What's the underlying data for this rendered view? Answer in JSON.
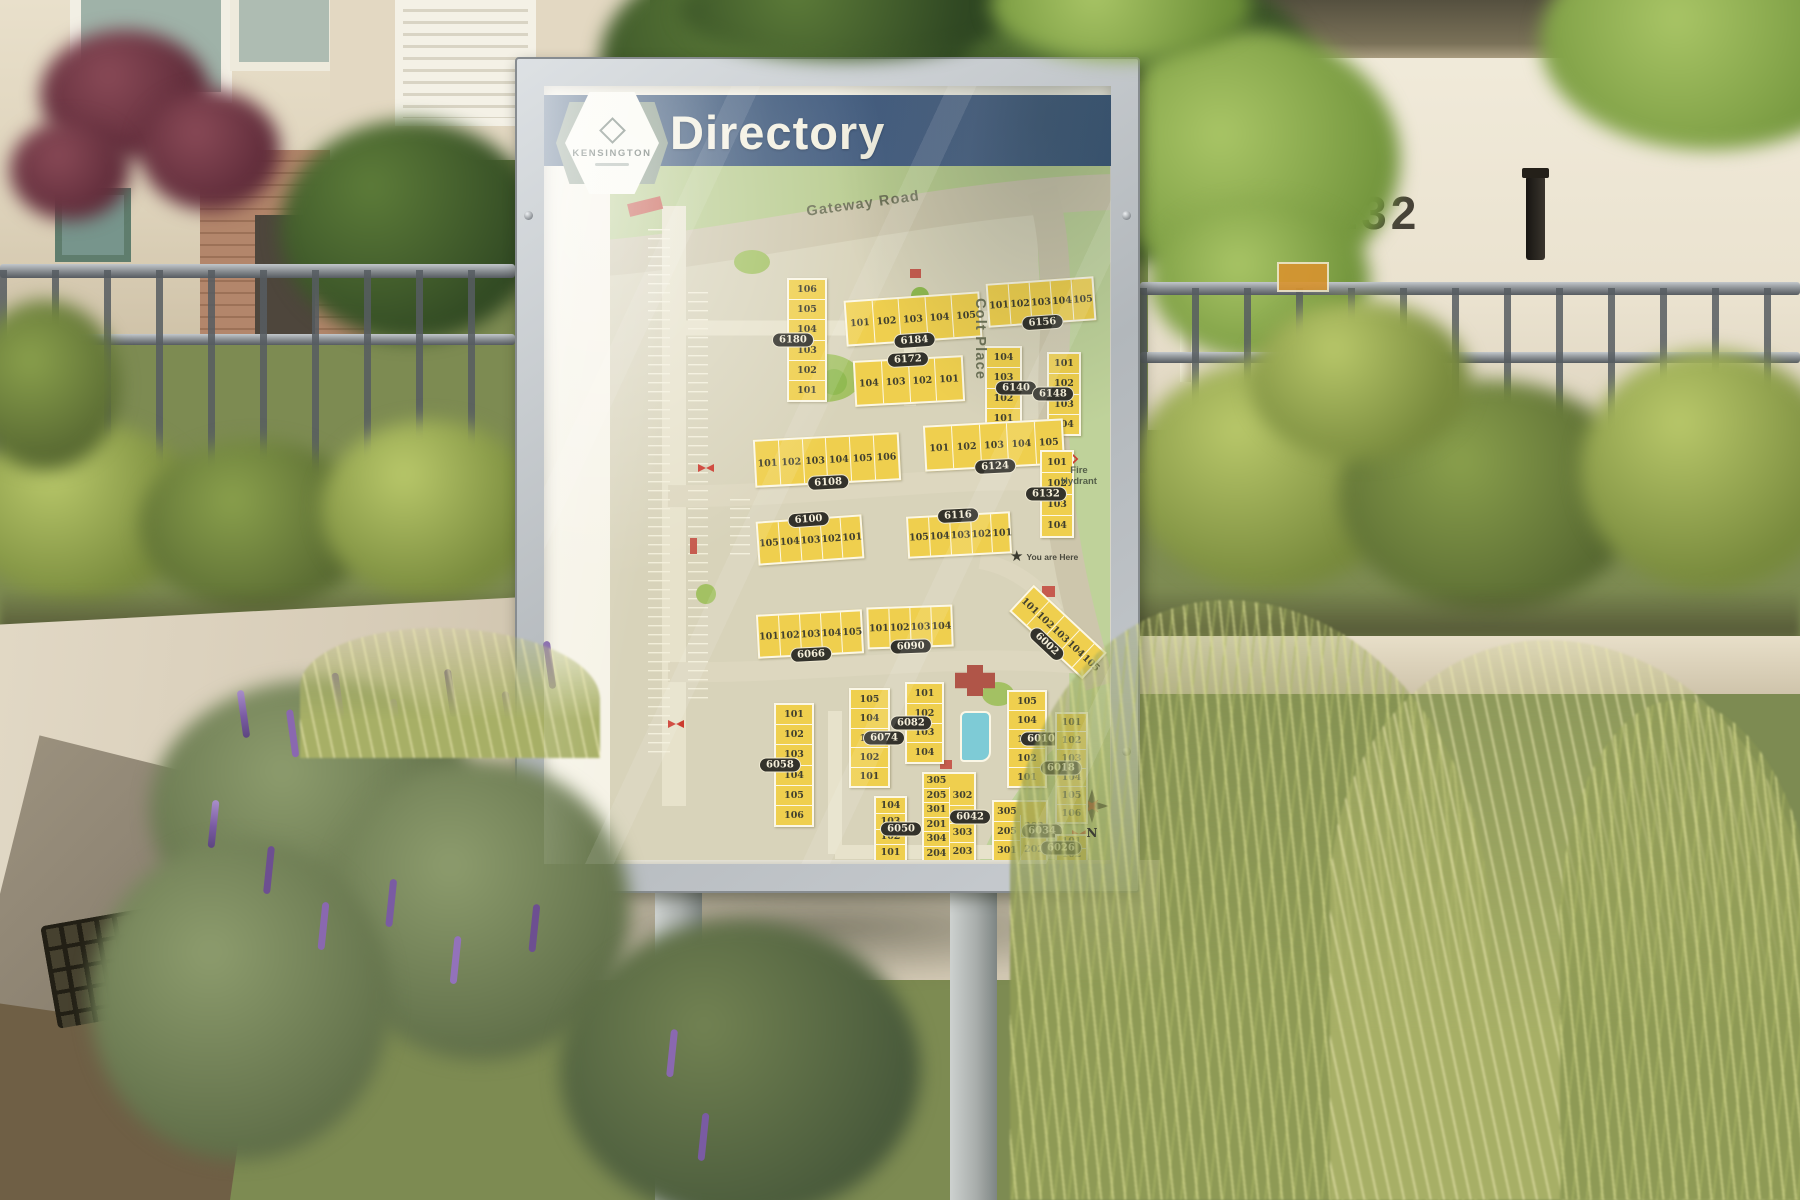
{
  "scene": {
    "right_building_number": "6132"
  },
  "sign": {
    "header": {
      "title": "Directory",
      "brand": "KENSINGTON"
    },
    "map": {
      "streets": [
        {
          "name": "Gateway Road"
        },
        {
          "name": "Colt Place"
        }
      ],
      "you_are_here_label": "You are Here",
      "legend": {
        "fire_hydrant_label": "Fire Hydrant"
      },
      "compass_label": "N",
      "buildings": [
        {
          "id": "6180",
          "ori": "v",
          "x": 177,
          "y": 112,
          "w": 40,
          "h": 124,
          "rot": 0,
          "label": "l",
          "units": [
            "106",
            "105",
            "104",
            "103",
            "102",
            "101"
          ]
        },
        {
          "id": "6184",
          "ori": "h",
          "x": 235,
          "y": 130,
          "w": 136,
          "h": 46,
          "rot": -4,
          "label": "b",
          "units": [
            "101",
            "102",
            "103",
            "104",
            "105"
          ]
        },
        {
          "id": "6156",
          "ori": "h",
          "x": 377,
          "y": 114,
          "w": 108,
          "h": 44,
          "rot": -4,
          "label": "b",
          "units": [
            "101",
            "102",
            "103",
            "104",
            "105"
          ]
        },
        {
          "id": "6172",
          "ori": "h",
          "x": 244,
          "y": 192,
          "w": 110,
          "h": 46,
          "rot": -3,
          "label": "t",
          "units": [
            "104",
            "103",
            "102",
            "101"
          ]
        },
        {
          "id": "6140",
          "ori": "v",
          "x": 375,
          "y": 180,
          "w": 37,
          "h": 84,
          "rot": 0,
          "label": "r",
          "units": [
            "104",
            "103",
            "102",
            "101"
          ]
        },
        {
          "id": "6148",
          "ori": "v",
          "x": 437,
          "y": 186,
          "w": 34,
          "h": 84,
          "rot": 0,
          "label": "l",
          "units": [
            "101",
            "102",
            "103",
            "104"
          ]
        },
        {
          "id": "6108",
          "ori": "h",
          "x": 144,
          "y": 270,
          "w": 146,
          "h": 48,
          "rot": -3,
          "label": "b",
          "units": [
            "101",
            "102",
            "103",
            "104",
            "105",
            "106"
          ]
        },
        {
          "id": "6124",
          "ori": "h",
          "x": 314,
          "y": 256,
          "w": 140,
          "h": 46,
          "rot": -3,
          "label": "b",
          "units": [
            "101",
            "102",
            "103",
            "104",
            "105"
          ]
        },
        {
          "id": "6132",
          "ori": "v",
          "x": 430,
          "y": 284,
          "w": 34,
          "h": 88,
          "rot": 0,
          "label": "l",
          "units": [
            "101",
            "102",
            "103",
            "104"
          ]
        },
        {
          "id": "6100",
          "ori": "h",
          "x": 147,
          "y": 352,
          "w": 106,
          "h": 44,
          "rot": -4,
          "label": "t",
          "units": [
            "105",
            "104",
            "103",
            "102",
            "101"
          ]
        },
        {
          "id": "6116",
          "ori": "h",
          "x": 297,
          "y": 348,
          "w": 104,
          "h": 42,
          "rot": -3,
          "label": "t",
          "units": [
            "105",
            "104",
            "103",
            "102",
            "101"
          ]
        },
        {
          "id": "6066",
          "ori": "h",
          "x": 147,
          "y": 446,
          "w": 106,
          "h": 44,
          "rot": -3,
          "label": "b",
          "units": [
            "101",
            "102",
            "103",
            "104",
            "105"
          ]
        },
        {
          "id": "6090",
          "ori": "h",
          "x": 257,
          "y": 440,
          "w": 86,
          "h": 42,
          "rot": -2,
          "label": "b",
          "units": [
            "101",
            "102",
            "103",
            "104"
          ]
        },
        {
          "id": "6002",
          "ori": "h",
          "x": 398,
          "y": 448,
          "w": 100,
          "h": 36,
          "rot": 43,
          "label": "b",
          "units": [
            "101",
            "102",
            "103",
            "104",
            "105"
          ]
        },
        {
          "id": "6058",
          "ori": "v",
          "x": 164,
          "y": 537,
          "w": 40,
          "h": 124,
          "rot": 0,
          "label": "l",
          "units": [
            "101",
            "102",
            "103",
            "104",
            "105",
            "106"
          ]
        },
        {
          "id": "6074",
          "ori": "v",
          "x": 239,
          "y": 522,
          "w": 41,
          "h": 100,
          "rot": 0,
          "label": "r",
          "units": [
            "105",
            "104",
            "103",
            "102",
            "101"
          ]
        },
        {
          "id": "6082",
          "ori": "v",
          "x": 295,
          "y": 516,
          "w": 39,
          "h": 82,
          "rot": 0,
          "label": "l",
          "units": [
            "101",
            "102",
            "103",
            "104"
          ]
        },
        {
          "id": "6010",
          "ori": "v",
          "x": 397,
          "y": 524,
          "w": 40,
          "h": 98,
          "rot": 0,
          "label": "r",
          "units": [
            "105",
            "104",
            "103",
            "102",
            "101"
          ]
        },
        {
          "id": "6018",
          "ori": "v",
          "x": 445,
          "y": 546,
          "w": 33,
          "h": 112,
          "rot": 0,
          "label": "l",
          "units": [
            "101",
            "102",
            "103",
            "104",
            "105",
            "106"
          ]
        },
        {
          "id": "6050",
          "ori": "v",
          "x": 264,
          "y": 630,
          "w": 33,
          "h": 66,
          "rot": 0,
          "label": "r",
          "units": [
            "104",
            "103",
            "102",
            "101"
          ]
        },
        {
          "id": "6042",
          "ori": "d2",
          "x": 312,
          "y": 606,
          "w": 54,
          "h": 90,
          "rot": 0,
          "label": "r",
          "units": [
            "305",
            "205",
            "301",
            "201",
            "304",
            "204"
          ],
          "units2": [
            "302",
            "202",
            "303",
            "203"
          ]
        },
        {
          "id": "6034",
          "ori": "d2",
          "x": 382,
          "y": 634,
          "w": 56,
          "h": 62,
          "rot": 0,
          "label": "r",
          "units": [
            "305",
            "205",
            "301"
          ],
          "units2": [
            "302",
            "202"
          ]
        },
        {
          "id": "6026",
          "ori": "v",
          "x": 445,
          "y": 668,
          "w": 33,
          "h": 28,
          "rot": 0,
          "label": "l",
          "units": [
            "101",
            "102"
          ]
        }
      ]
    }
  }
}
